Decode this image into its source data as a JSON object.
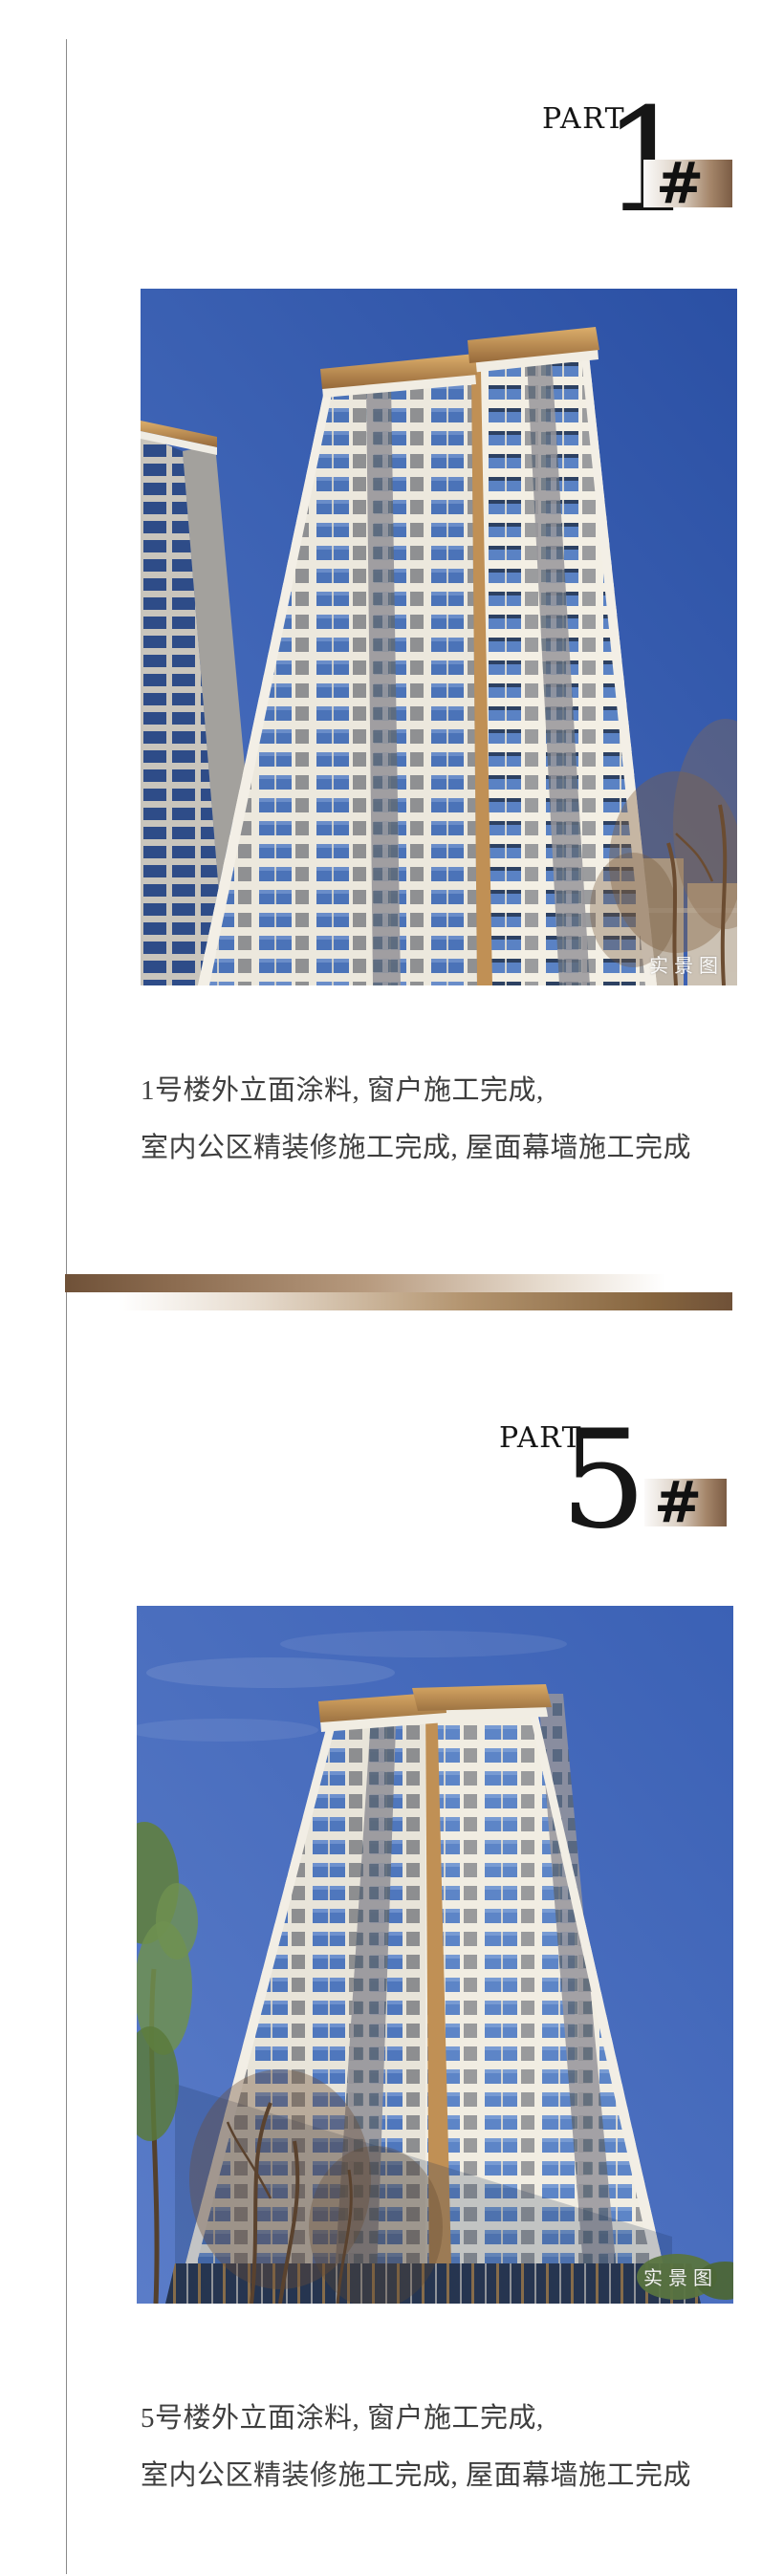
{
  "page": {
    "background": "#ffffff",
    "left_rule_color": "#8a8a8a"
  },
  "colors": {
    "accent_brown_dark": "#6f5138",
    "accent_brown_mid": "#9a7a5c",
    "header_text": "#141414",
    "caption_text": "#3e3e3e",
    "sky_blue_photo1": "#3a5fb1",
    "sky_blue_photo2": "#4468b8",
    "watermark_white": "#ffffff"
  },
  "sections": [
    {
      "part_label": "PART",
      "part_number": "1",
      "hash_symbol": "#",
      "photo_watermark": "实景图",
      "caption_line1": "1号楼外立面涂料, 窗户施工完成,",
      "caption_line2": "室内公区精装修施工完成, 屋面幕墙施工完成"
    },
    {
      "part_label": "PART",
      "part_number": "5",
      "hash_symbol": "#",
      "photo_watermark": "实景图",
      "caption_line1": "5号楼外立面涂料, 窗户施工完成,",
      "caption_line2": "室内公区精装修施工完成, 屋面幕墙施工完成"
    }
  ]
}
